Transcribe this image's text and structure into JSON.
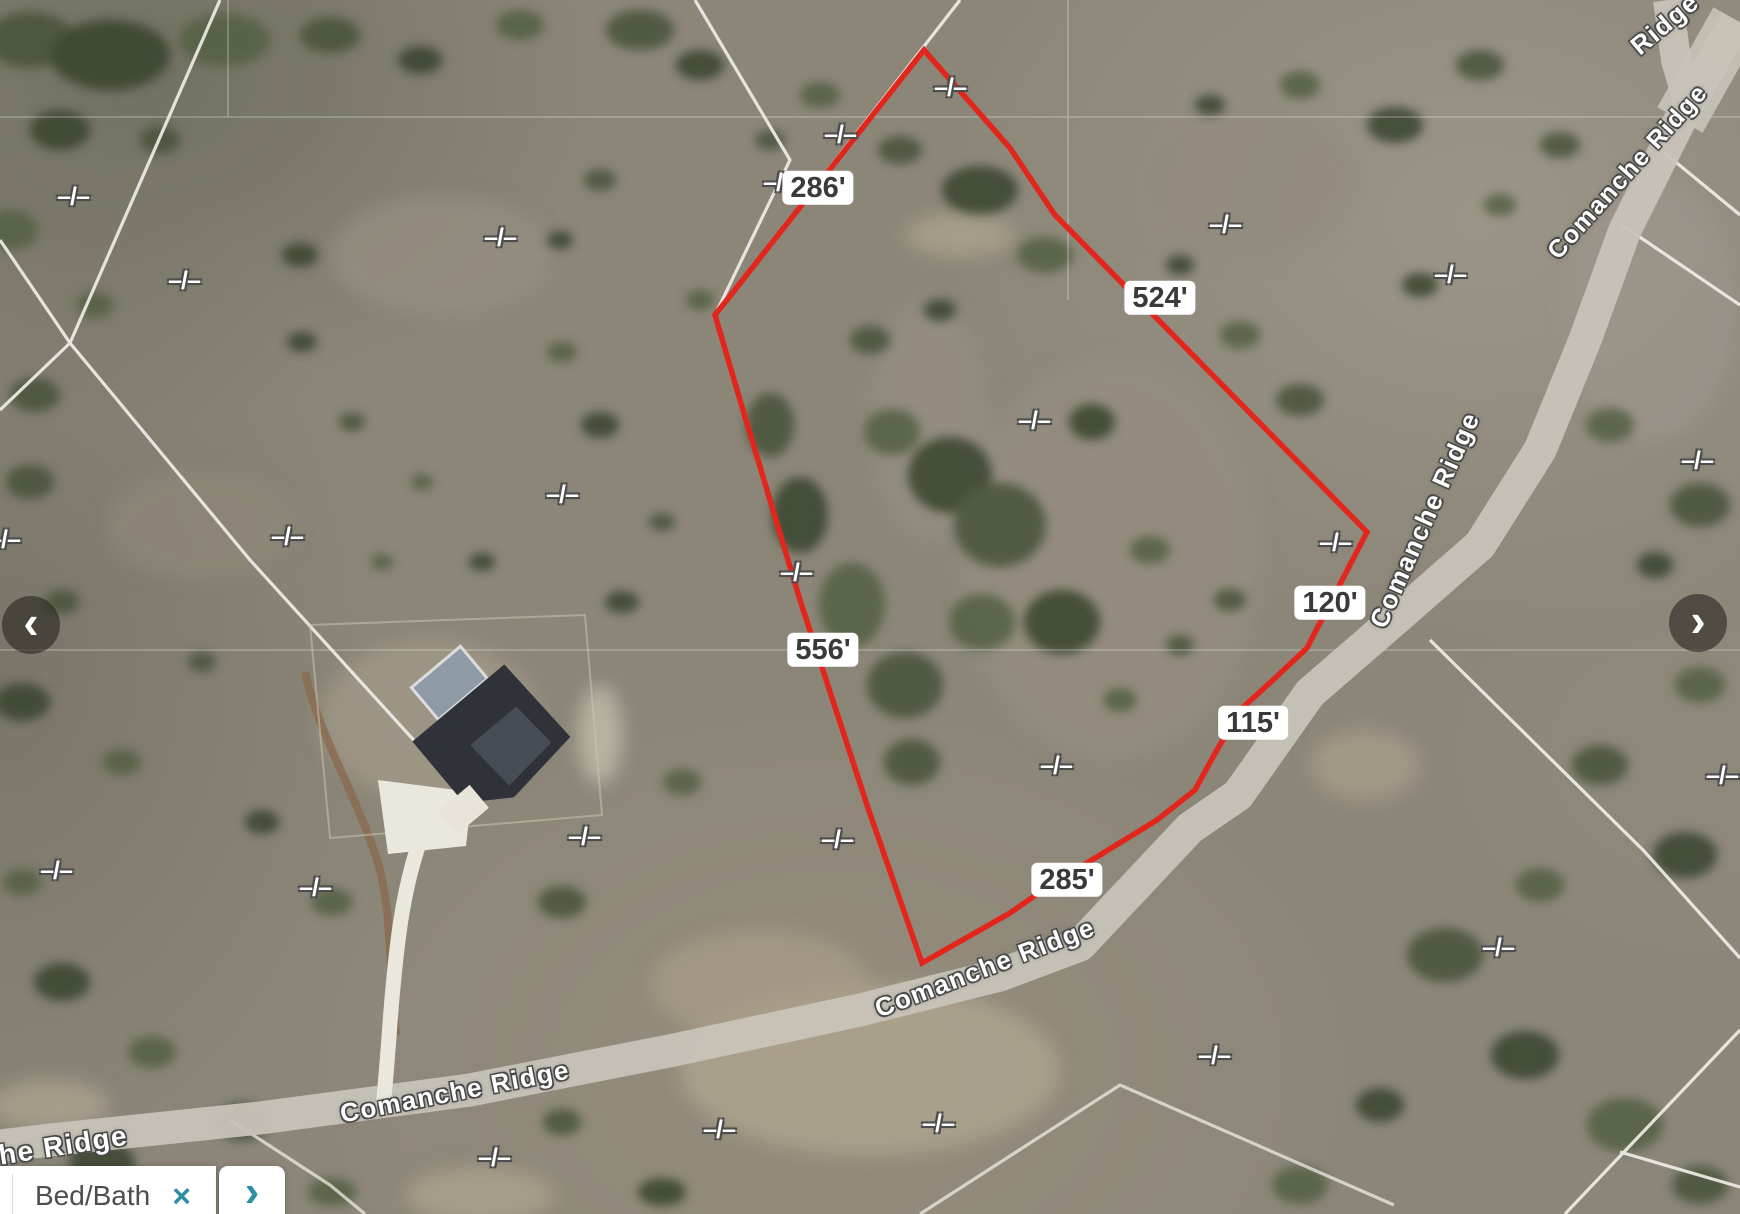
{
  "map": {
    "parcel": {
      "stroke": "#e2261c",
      "points": [
        [
          924,
          50
        ],
        [
          715,
          315
        ],
        [
          740,
          400
        ],
        [
          800,
          600
        ],
        [
          868,
          808
        ],
        [
          922,
          963
        ],
        [
          1010,
          913
        ],
        [
          1043,
          890
        ],
        [
          1100,
          855
        ],
        [
          1157,
          820
        ],
        [
          1195,
          790
        ],
        [
          1213,
          757
        ],
        [
          1240,
          710
        ],
        [
          1273,
          680
        ],
        [
          1307,
          648
        ],
        [
          1367,
          532
        ],
        [
          1055,
          215
        ],
        [
          1010,
          148
        ]
      ]
    },
    "measurements": [
      {
        "label": "286'",
        "x": 818,
        "y": 188
      },
      {
        "label": "524'",
        "x": 1160,
        "y": 298
      },
      {
        "label": "556'",
        "x": 823,
        "y": 650
      },
      {
        "label": "120'",
        "x": 1330,
        "y": 603
      },
      {
        "label": "115'",
        "x": 1253,
        "y": 723
      },
      {
        "label": "285'",
        "x": 1067,
        "y": 880
      }
    ],
    "missing_dimension_glyph": "–/–",
    "missing_dimension_markers": [
      [
        73,
        197
      ],
      [
        184,
        281
      ],
      [
        500,
        238
      ],
      [
        950,
        88
      ],
      [
        840,
        135
      ],
      [
        779,
        183
      ],
      [
        1225,
        225
      ],
      [
        1450,
        275
      ],
      [
        1697,
        461
      ],
      [
        4,
        540
      ],
      [
        287,
        537
      ],
      [
        562,
        495
      ],
      [
        1034,
        421
      ],
      [
        796,
        573
      ],
      [
        1335,
        543
      ],
      [
        1722,
        776
      ],
      [
        56,
        871
      ],
      [
        315,
        888
      ],
      [
        584,
        837
      ],
      [
        837,
        840
      ],
      [
        1056,
        766
      ],
      [
        1498,
        948
      ],
      [
        1214,
        1056
      ],
      [
        719,
        1130
      ],
      [
        938,
        1124
      ],
      [
        494,
        1158
      ]
    ],
    "road_labels": [
      {
        "text": "Ridge",
        "x": 1665,
        "y": 24,
        "angle": -40,
        "size": 26
      },
      {
        "text": "Comanche Ridge",
        "x": 1628,
        "y": 172,
        "angle": -48,
        "size": 25
      },
      {
        "text": "Comanche Ridge",
        "x": 1425,
        "y": 520,
        "angle": -66,
        "size": 26
      },
      {
        "text": "Comanche Ridge",
        "x": 985,
        "y": 968,
        "angle": -21,
        "size": 26
      },
      {
        "text": "Comanche Ridge",
        "x": 455,
        "y": 1092,
        "angle": -11,
        "size": 26
      },
      {
        "text": "che Ridge",
        "x": 55,
        "y": 1147,
        "angle": -9,
        "size": 28
      }
    ]
  },
  "nav": {
    "prev": "‹",
    "next": "›"
  },
  "filter_bar": {
    "chip_label": "Bed/Bath",
    "chip_close": "×",
    "scroll_next": "›"
  },
  "colors": {
    "parcel_red": "#e2261c",
    "accent_teal": "#2e8fa3",
    "dimension_text": "#3a3a3a",
    "road_label": "#ffffff"
  }
}
